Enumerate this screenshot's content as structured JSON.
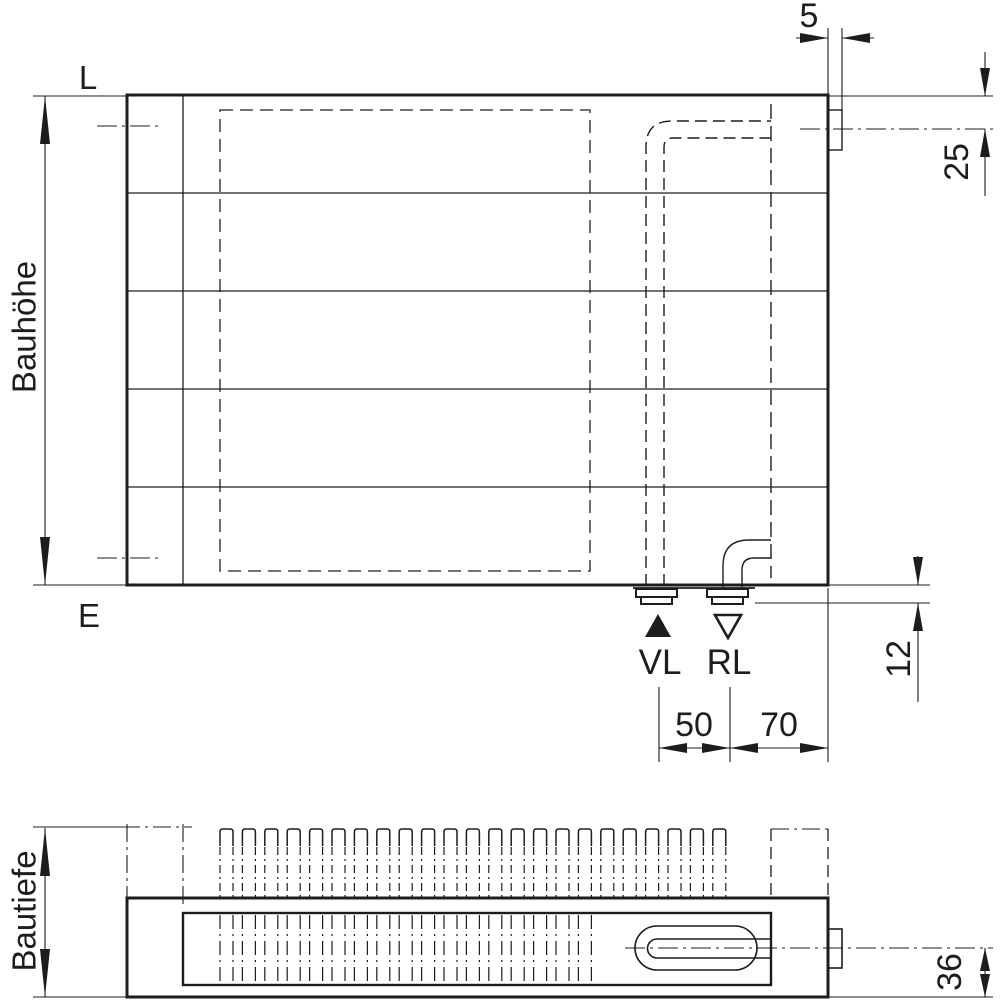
{
  "meta": {
    "background_color": "#ffffff",
    "line_color": "#1d1d1b",
    "drawing_type": "radiator technical dimension drawing, front view and top view"
  },
  "front_view": {
    "label_top_left": "L",
    "label_bottom_left": "E",
    "height_label": "Bauhöhe",
    "supply_label": "VL",
    "return_label": "RL",
    "dims": {
      "bracket_width": "5",
      "top_connection_offset": "25",
      "bottom_connection_offset": "12",
      "supply_return_spacing": "50",
      "return_to_edge": "70"
    }
  },
  "top_view": {
    "depth_label": "Bautiefe",
    "dims": {
      "connection_center_to_front": "36"
    }
  }
}
